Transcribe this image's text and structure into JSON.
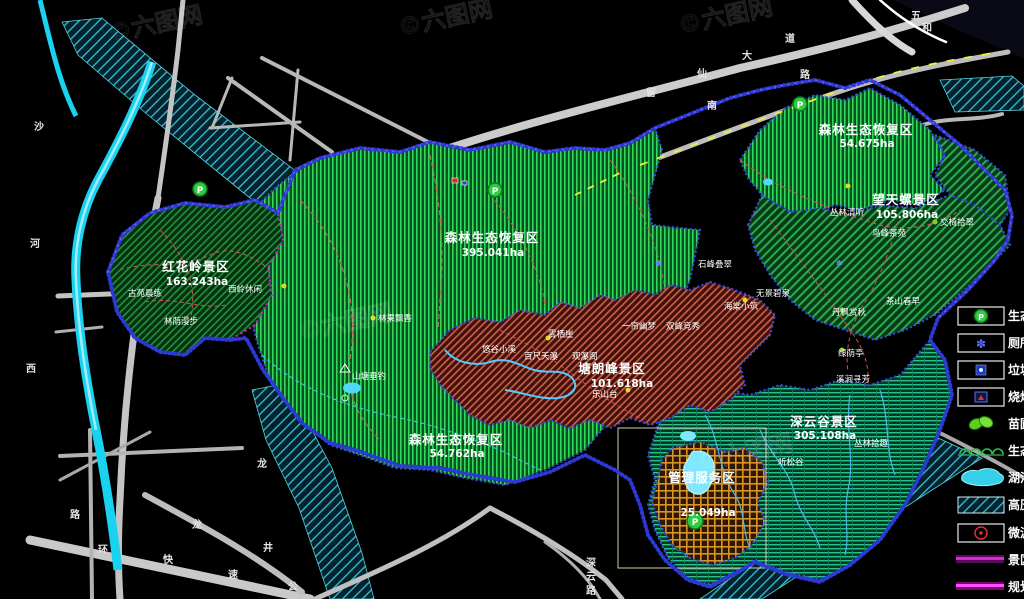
{
  "app": {
    "type": "cad-planning-map",
    "background": "#000000"
  },
  "watermark": {
    "text": "©六图网"
  },
  "colors": {
    "forest_hatch": "#35d65e",
    "forest_bg": "#06531f",
    "diag_green": "#2cab4e",
    "brown_hatch": "#c4604a",
    "teal_hatch": "#2cc287",
    "orange_grid": "#d89428",
    "boundary_blue": "#3c49e0",
    "planning_magenta": "#d818d8",
    "water_cyan": "#19d2f0",
    "road_gray": "#c4c4c4",
    "dash_yellow": "#f2ef3a",
    "trail_red": "#d85050",
    "parking_green": "#2ecc40"
  },
  "regions": [
    {
      "name": "红花岭景区",
      "area": "163.243ha"
    },
    {
      "name": "森林生态恢复区",
      "area": "395.041ha"
    },
    {
      "name": "森林生态恢复区",
      "area": "54.762ha"
    },
    {
      "name": "塘朗峰景区",
      "area": "101.618ha"
    },
    {
      "name": "森林生态恢复区",
      "area": "54.675ha"
    },
    {
      "name": "望天螺景区",
      "area": "105.806ha"
    },
    {
      "name": "深云谷景区",
      "area": "305.108ha"
    },
    {
      "name": "管理服务区",
      "area": "25.049ha"
    }
  ],
  "points": [
    {
      "label": "西岭休闲"
    },
    {
      "label": "古苑晨练"
    },
    {
      "label": "林荫漫步"
    },
    {
      "label": "林果飘香"
    },
    {
      "label": "山塘垂钓"
    },
    {
      "label": "悠谷小溪"
    },
    {
      "label": "百尺天瀑"
    },
    {
      "label": "观瀑阁"
    },
    {
      "label": "雾栖崖"
    },
    {
      "label": "乐山台"
    },
    {
      "label": "一帘幽梦"
    },
    {
      "label": "双峰竞秀"
    },
    {
      "label": "石峰叠翠"
    },
    {
      "label": "海棠小筑"
    },
    {
      "label": "无景碧泉"
    },
    {
      "label": "鸟峰茶苑"
    },
    {
      "label": "交椅拾翠"
    },
    {
      "label": "茶山春早"
    },
    {
      "label": "丹枫赏秋"
    },
    {
      "label": "绿荫亭"
    },
    {
      "label": "溪涧寻芳"
    },
    {
      "label": "听松谷"
    },
    {
      "label": "丛林拾趣"
    },
    {
      "label": "丛林清听"
    }
  ],
  "road_chars": [
    {
      "c": "沙"
    },
    {
      "c": "河"
    },
    {
      "c": "西"
    },
    {
      "c": "路"
    },
    {
      "c": "留"
    },
    {
      "c": "仙"
    },
    {
      "c": "大"
    },
    {
      "c": "道"
    },
    {
      "c": "南"
    },
    {
      "c": "路"
    },
    {
      "c": "五"
    },
    {
      "c": "和"
    },
    {
      "c": "环"
    },
    {
      "c": "快"
    },
    {
      "c": "速"
    },
    {
      "c": "龙"
    },
    {
      "c": "龙"
    },
    {
      "c": "井"
    },
    {
      "c": "公"
    },
    {
      "c": "深"
    },
    {
      "c": "云"
    },
    {
      "c": "路"
    }
  ],
  "legend": {
    "items": [
      {
        "label": "生态停车场",
        "icon": "parking-icon"
      },
      {
        "label": "厕所",
        "icon": "toilet-icon"
      },
      {
        "label": "垃圾箱",
        "icon": "trash-icon"
      },
      {
        "label": "烧烤场",
        "icon": "bbq-icon"
      },
      {
        "label": "苗圃",
        "icon": "nursery-icon"
      },
      {
        "label": "生态长廊",
        "icon": "corridor-icon"
      },
      {
        "label": "湖泊",
        "icon": "lake-icon"
      },
      {
        "label": "高压走廊",
        "icon": "hv-corridor-icon"
      },
      {
        "label": "微波站",
        "icon": "microwave-icon"
      },
      {
        "label": "景区界线",
        "icon": "scenic-boundary-icon"
      },
      {
        "label": "规划红线",
        "icon": "planning-line-icon"
      }
    ]
  }
}
